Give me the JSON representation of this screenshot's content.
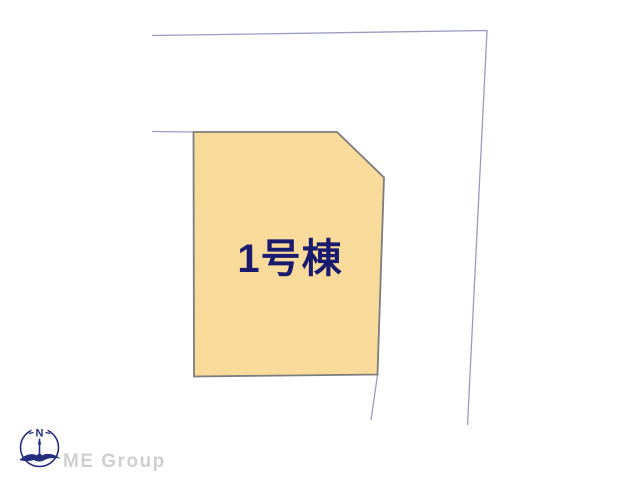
{
  "canvas": {
    "width": 640,
    "height": 480,
    "background": "#ffffff"
  },
  "diagram": {
    "type": "site-plan",
    "lot": {
      "label": "1号棟",
      "fill": "#f8db9b",
      "border": "#7d7d7d",
      "points": "193.5,132 337,132 384,177.5 377.5,374.5 194,376.5",
      "label_x": "290",
      "label_y": "272",
      "label_color": "#1a1a6e"
    },
    "boundaries": {
      "color": "#9a9ac2",
      "outer": "152,35.5 487,30.5 467.5,425",
      "left_stub": "152,131.5 194,132",
      "lower_stub": "377.5,375 371,420"
    }
  },
  "footer_logo": {
    "compass_letter": "N",
    "company_name": "ME Group",
    "icon_color": "#252d7d",
    "text_color": "#cfcfcf"
  }
}
